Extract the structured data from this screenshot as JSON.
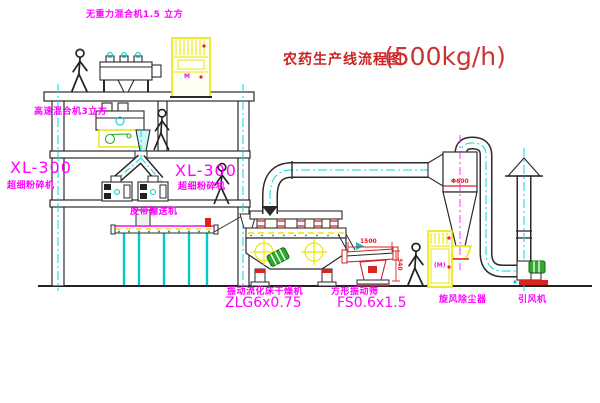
{
  "title": {
    "text": "农药生产线流程图",
    "capacity": "(500kg/h)"
  },
  "equipment_labels": {
    "gravity_mixer": "无重力混合机1.5 立方",
    "high_speed_mixer": "高速混合机3立方",
    "left_mill_model": "XL-300",
    "left_mill_name": "超细粉碎机",
    "center_mill_model": "XL-300",
    "center_mill_name": "超细粉碎机",
    "belt_conveyor": "皮带输送机",
    "dryer_name": "振动流化床干燥机",
    "dryer_model": "ZLG6x0.75",
    "screen_name": "方形振动筛",
    "screen_model": "FS0.6x1.5",
    "cyclone": "旋风除尘器",
    "fan": "引风机"
  },
  "dimension_texts": {
    "screen_length": "1500",
    "screen_height": "340",
    "cyclone_diameter": "Φ600"
  },
  "motor_markers": {
    "elevator": "M",
    "collector": "(M)"
  },
  "colors": {
    "label_magenta": "#ff00ff",
    "title_red": "#cc2222",
    "centerline_cyan": "#00dddd",
    "equipment_yellow": "#e8e800",
    "motor_green": "#2faa2f",
    "accent_red": "#dd2222",
    "line_black": "#2a2a2a"
  }
}
